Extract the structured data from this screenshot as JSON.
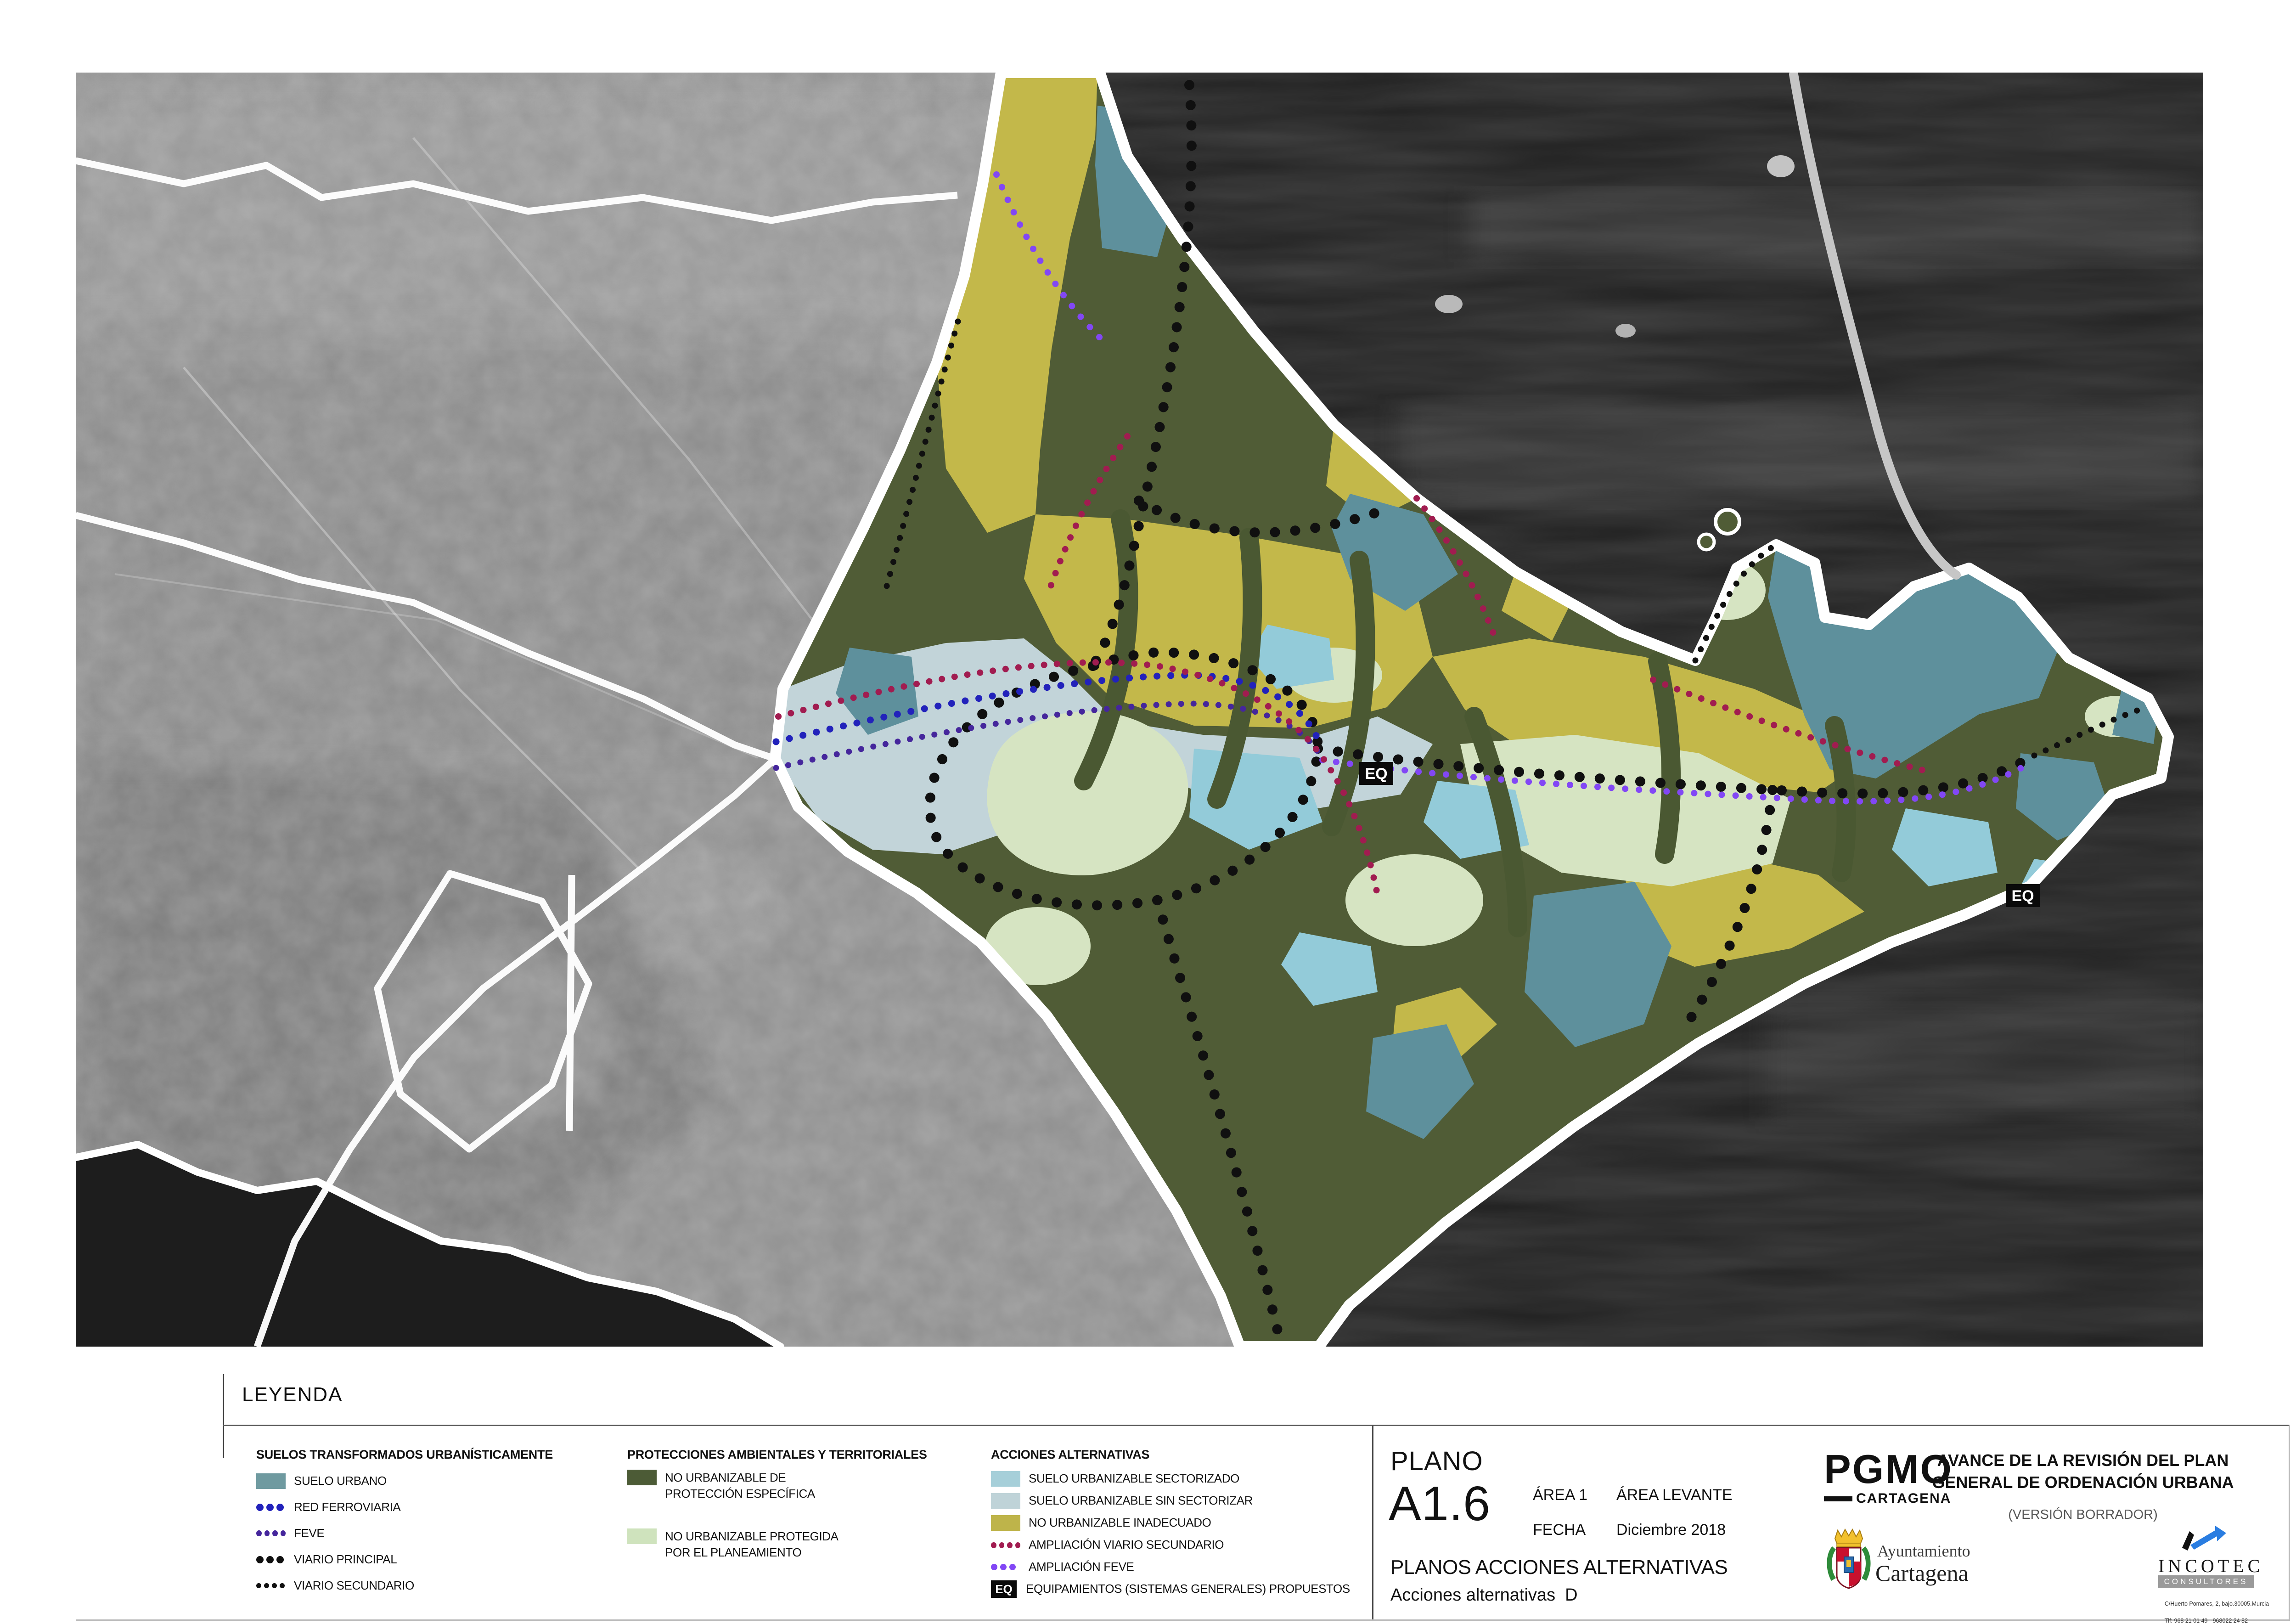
{
  "sheet": {
    "leyenda_title": "LEYENDA"
  },
  "legend": {
    "columns": [
      {
        "header": "SUELOS TRANSFORMADOS URBANÍSTICAMENTE",
        "items": [
          {
            "type": "swatch",
            "color": "#6f9aa0",
            "label": "SUELO URBANO"
          },
          {
            "type": "dots",
            "color": "#2222bb",
            "label": "RED FERROVIARIA"
          },
          {
            "type": "dots",
            "color": "#45269c",
            "label": "FEVE"
          },
          {
            "type": "dots",
            "color": "#101010",
            "label": "VIARIO PRINCIPAL"
          },
          {
            "type": "dots",
            "color": "#101010",
            "label": "VIARIO SECUNDARIO"
          }
        ]
      },
      {
        "header": "PROTECCIONES AMBIENTALES Y TERRITORIALES",
        "items": [
          {
            "type": "swatch",
            "color": "#4c5b36",
            "label_line1": "NO URBANIZABLE DE",
            "label_line2": "PROTECCIÓN ESPECÍFICA"
          },
          {
            "type": "swatch",
            "color": "#cfe3bd",
            "label_line1": "NO URBANIZABLE PROTEGIDA",
            "label_line2": "POR EL PLANEAMIENTO"
          }
        ]
      },
      {
        "header": "ACCIONES ALTERNATIVAS",
        "items": [
          {
            "type": "swatch",
            "color": "#a6cfd9",
            "label": "SUELO URBANIZABLE SECTORIZADO"
          },
          {
            "type": "swatch",
            "color": "#bfd3d8",
            "label": "SUELO URBANIZABLE SIN SECTORIZAR"
          },
          {
            "type": "swatch",
            "color": "#beb44a",
            "label": "NO URBANIZABLE INADECUADO"
          },
          {
            "type": "dots",
            "color": "#a11c50",
            "label": "AMPLIACIÓN VIARIO SECUNDARIO"
          },
          {
            "type": "dots",
            "color": "#8247f5",
            "label": "AMPLIACIÓN FEVE"
          },
          {
            "type": "eq",
            "chip": "EQ",
            "label": "EQUIPAMIENTOS (SISTEMAS GENERALES) PROPUESTOS"
          }
        ]
      }
    ]
  },
  "titleblock": {
    "plano_label": "PLANO",
    "plano_code": "A1.6",
    "area_label": "ÁREA 1",
    "area_value": "ÁREA LEVANTE",
    "fecha_label": "FECHA",
    "fecha_value": "Diciembre 2018",
    "series_title": "PLANOS ACCIONES ALTERNATIVAS",
    "sheet_subtitle": "Acciones alternativas  D"
  },
  "branding": {
    "pgmo_logo": "PGMO",
    "pgmo_sub": "CARTAGENA",
    "avance_line1": "AVANCE DE LA REVISIÓN DEL PLAN",
    "avance_line2": "GENERAL DE ORDENACIÓN URBANA",
    "version_note": "(VERSIÓN BORRADOR)",
    "ayto_line1": "Ayuntamiento",
    "ayto_line2": "Cartagena",
    "incotec_name": "INCOTEC",
    "incotec_sub": "CONSULTORES",
    "incotec_addr1": "C/Huerto Pomares, 2, bajo.30005.Murcia",
    "incotec_addr2": "Tlf: 968 21 01 49 - 968022 24 82"
  },
  "map": {
    "eq_marker_text": "EQ",
    "colors": {
      "sea": "#202020",
      "land_gray": "#8f8f8f",
      "boundary_white": "#ffffff",
      "suelo_urbano_teal": "#5e909c",
      "urbanizable_sectorizado": "#93cbd9",
      "urbanizable_sin_sectorizar": "#c2d4d9",
      "no_urbanizable_inadecuado": "#c3b84a",
      "proteccion_especifica_olive": "#505c36",
      "protegida_planeamiento": "#d6e4c2",
      "viario_black": "#101010",
      "ampliacion_viario_crimson": "#a11c50",
      "ampliacion_feve_purple": "#8247f5",
      "red_ferroviaria_blue": "#2222bb",
      "feve_violet": "#45269c"
    }
  }
}
